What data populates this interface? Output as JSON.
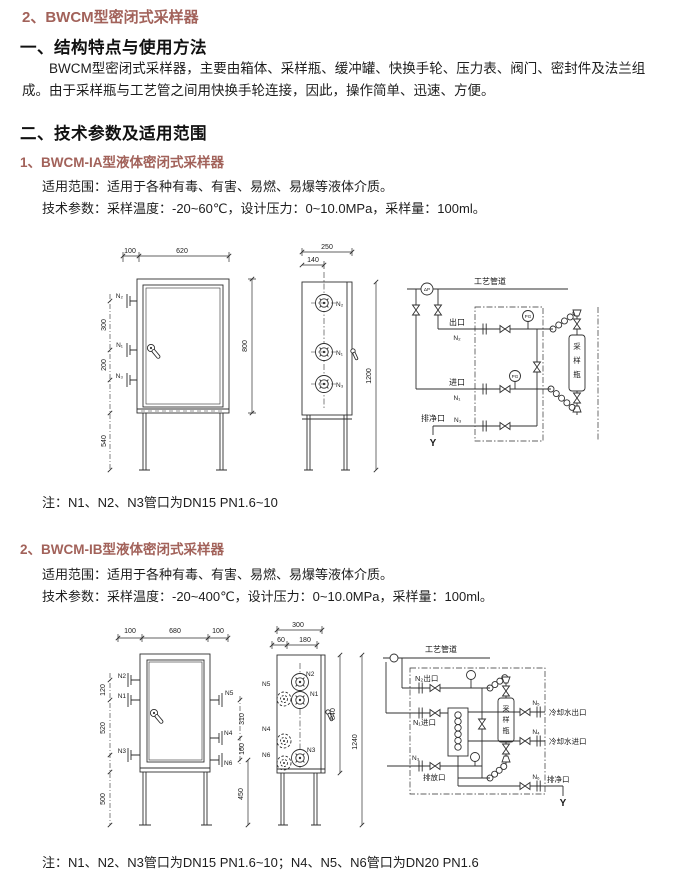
{
  "page": {
    "accent": "#a2625a"
  },
  "title": "2、BWCM型密闭式采样器",
  "sec1": {
    "heading": "一、结构特点与使用方法",
    "body": "BWCM型密闭式采样器，主要由箱体、采样瓶、缓冲罐、快换手轮、压力表、阀门、密封件及法兰组成。由于采样瓶与工艺管之间用快换手轮连接，因此，操作简单、迅速、方便。"
  },
  "sec2": {
    "heading": "二、技术参数及适用范围"
  },
  "modelA": {
    "heading": "1、BWCM-IA型液体密闭式采样器",
    "scope": "适用范围：适用于各种有毒、有害、易燃、易爆等液体介质。",
    "params": "技术参数：采样温度：-20~60℃，设计压力：0~10.0MPa，采样量：100ml。",
    "note": "注：N1、N2、N3管口为DN15  PN1.6~10"
  },
  "modelB": {
    "heading": "2、BWCM-IB型液体密闭式采样器",
    "scope": "适用范围：适用于各种有毒、有害、易燃、易爆等液体介质。",
    "params": "技术参数：采样温度：-20~400℃，设计压力：0~10.0MPa，采样量：100ml。",
    "note": "注：N1、N2、N3管口为DN15  PN1.6~10；N4、N5、N6管口为DN20  PN1.6"
  },
  "figA": {
    "front": {
      "d100": "100",
      "d620": "620",
      "d300": "300",
      "d200": "200",
      "d540": "540",
      "d800": "800",
      "n2": "N₂",
      "n1": "N₁",
      "n3": "N₃"
    },
    "side": {
      "d250": "250",
      "d140": "140",
      "d1200": "1200",
      "n2": "N₂",
      "n1": "N₁",
      "n3": "N₃"
    },
    "schem": {
      "pipeline": "工艺管道",
      "dp": "ΔP",
      "pg1": "PG",
      "pg2": "PG",
      "outlet": "出口",
      "outlet_n": "N₂",
      "inlet": "进口",
      "inlet_n": "N₁",
      "drain": "排净口",
      "drain_n": "N₃",
      "bottle": [
        "采",
        "样",
        "瓶"
      ],
      "y": "Y"
    }
  },
  "figB": {
    "front": {
      "d100l": "100",
      "d680": "680",
      "d100r": "100",
      "d120": "120",
      "d520": "520",
      "d500": "500",
      "d310": "310",
      "d160": "160",
      "d450": "450",
      "n1": "N1",
      "n2": "N2",
      "n3": "N3",
      "n4": "N4",
      "n5": "N5",
      "n6": "N6"
    },
    "side": {
      "d300": "300",
      "d60": "60",
      "d180": "180",
      "d840": "840",
      "d1240": "1240",
      "n1": "N1",
      "n2": "N2",
      "n3": "N3",
      "n4": "N4",
      "n5": "N5",
      "n6": "N6"
    },
    "schem": {
      "pipeline": "工艺管道",
      "outlet": "N₂出口",
      "inlet": "N₁进口",
      "n3": "N₃",
      "discharge": "排放口",
      "bottle": [
        "采",
        "样",
        "瓶"
      ],
      "cw_out_n": "N₅",
      "cw_out": "冷却水出口",
      "cw_in_n": "N₄",
      "cw_in": "冷却水进口",
      "drain_n": "N₆",
      "drain": "排净口",
      "y": "Y"
    }
  }
}
